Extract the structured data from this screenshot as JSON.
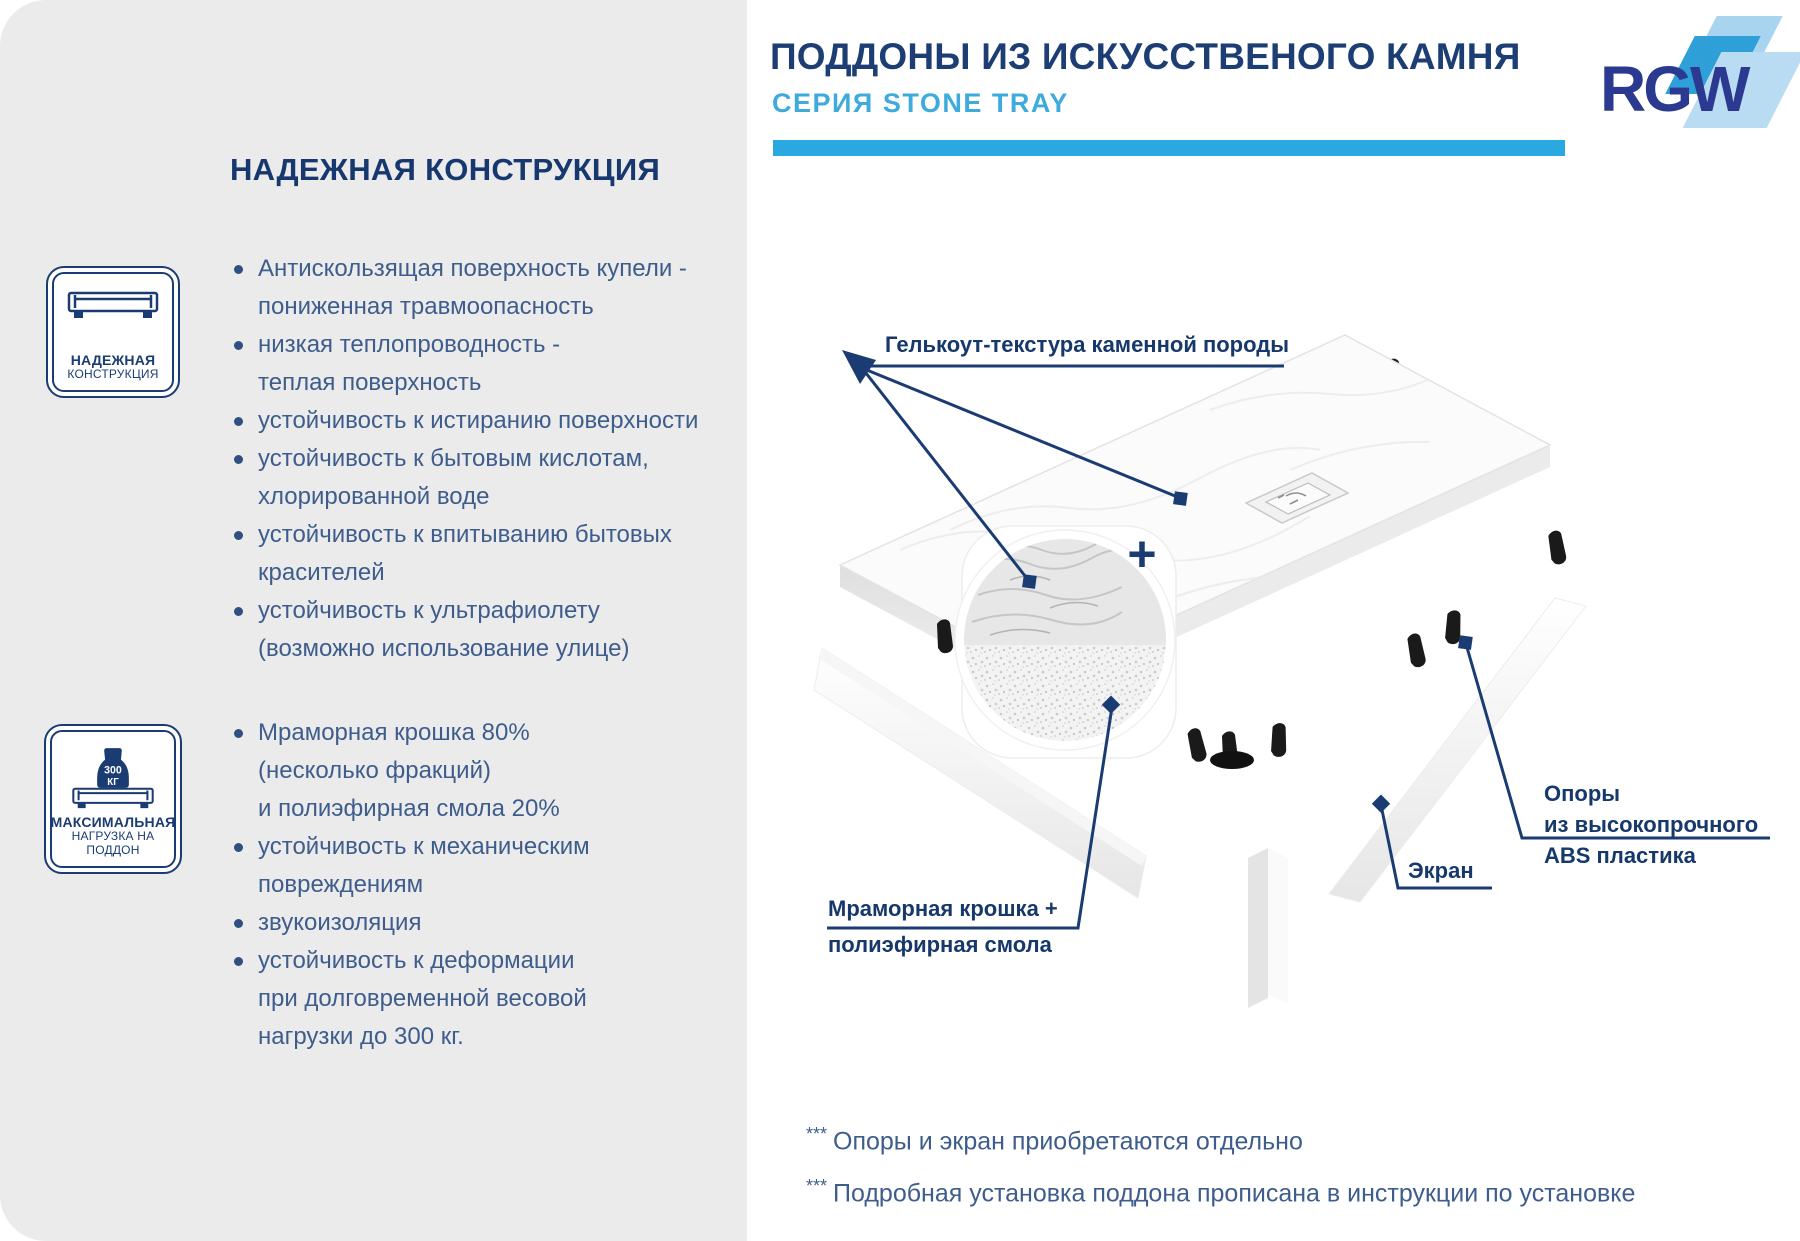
{
  "header": {
    "title": "ПОДДОНЫ ИЗ ИСКУССТВЕНОГО КАМНЯ",
    "subtitle": "СЕРИЯ STONE TRAY"
  },
  "logo": {
    "text": "RGW"
  },
  "colors": {
    "panel_bg": "#ebebeb",
    "navy": "#1b3c73",
    "steel_blue_text": "#3e5d8c",
    "accent_light_blue": "#29a9e0",
    "logo_navy": "#2b3990"
  },
  "left_panel": {
    "heading": "НАДЕЖНАЯ КОНСТРУКЦИЯ",
    "badge1": {
      "line1": "НАДЕЖНАЯ",
      "line2": "КОНСТРУКЦИЯ"
    },
    "badge2": {
      "weight_value": "300",
      "weight_unit": "КГ",
      "line1": "МАКСИМАЛЬНАЯ",
      "line2": "НАГРУЗКА НА ПОДДОН"
    },
    "list1": [
      {
        "lines": [
          "Антискользящая поверхность купели -",
          "пониженная травмоопасность"
        ]
      },
      {
        "lines": [
          "низкая теплопроводность -",
          "теплая поверхность"
        ]
      },
      {
        "lines": [
          "устойчивость к истиранию поверхности"
        ]
      },
      {
        "lines": [
          "устойчивость к бытовым кислотам,",
          "хлорированной воде"
        ]
      },
      {
        "lines": [
          "устойчивость к впитыванию бытовых",
          "красителей"
        ]
      },
      {
        "lines": [
          "устойчивость к ультрафиолету",
          "(возможно использование улице)"
        ]
      }
    ],
    "list2": [
      {
        "lines": [
          "Мраморная крошка 80%",
          "(несколько фракций)",
          "и полиэфирная смола 20%"
        ]
      },
      {
        "lines": [
          "устойчивость к механическим",
          "повреждениям"
        ]
      },
      {
        "lines": [
          "звукоизоляция"
        ]
      },
      {
        "lines": [
          "устойчивость к деформации",
          "при долговременной весовой",
          "нагрузки до 300 кг."
        ]
      }
    ]
  },
  "diagram": {
    "labels": {
      "gelcoat": "Гелькоут-текстура каменной породы",
      "marble_line1": "Мраморная крошка +",
      "marble_line2": "полиэфирная смола",
      "screen": "Экран",
      "supports_line1": "Опоры",
      "supports_line2": "из высокопрочного",
      "supports_line3": "ABS пластика",
      "plus": "+"
    },
    "footnotes": [
      {
        "mark": "***",
        "text": "Опоры и экран приобретаются отдельно"
      },
      {
        "mark": "***",
        "text": "Подробная установка поддона прописана в инструкции по установке"
      }
    ]
  }
}
